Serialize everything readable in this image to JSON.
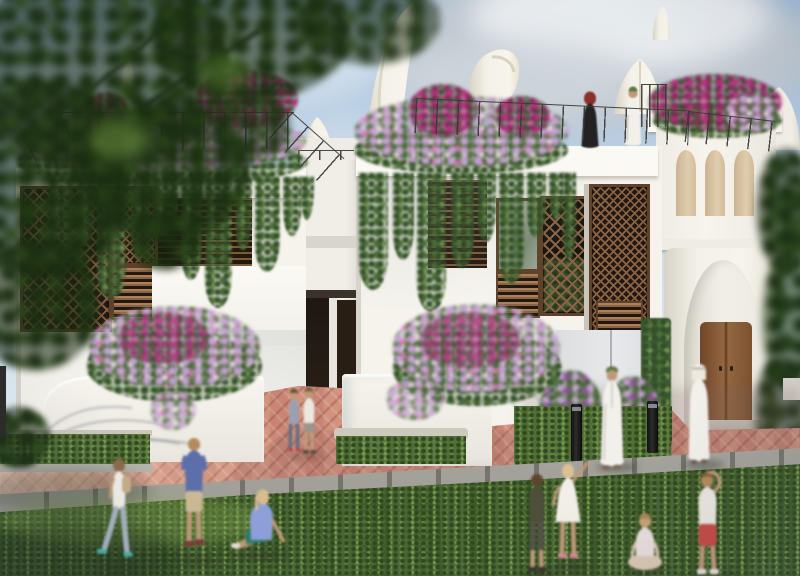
{
  "meta": {
    "type": "architectural-visualization",
    "description": "Sunlit rendering of white Arabian-style courtyard villas with wooden mashrabiya screens, cascading rooftop bougainvillea gardens, sail-shaped roof sculptures, a gateway tower with a wooden door, herringbone brick paths and children playing on a green lawn",
    "time_of_day": "late afternoon",
    "weather": "partly cloudy"
  },
  "palette": {
    "sky-top": "#9cbad9",
    "sky-mid": "#c3d7ea",
    "sky-low": "#e4eef6",
    "cloud-grey": "#c2c9d0",
    "cloud-light": "#e9edf0",
    "wall": "#f5f3ec",
    "wall-bright": "#fbf9f3",
    "wall-shade": "#e5e3db",
    "wall-grey": "#e0e1e3",
    "sail": "#f3f0e7",
    "sail-shade": "#d8d3c4",
    "wood": "#8a6342",
    "wood-dark": "#5e4128",
    "wood-deep": "#231811",
    "wood-light": "#aa8159",
    "glass": "#95a38d",
    "niche": "#dbc7a7",
    "door-a": "#936740",
    "door-b": "#6e4628",
    "rail": "#3a3a36",
    "vine": "#4d6d39",
    "vine-dark": "#33502a",
    "vine-light": "#70924f",
    "fl-magenta": "#bb3380",
    "fl-deep": "#8e2260",
    "fl-pink": "#d873ae",
    "fl-lav": "#c7a2d6",
    "fl-pale": "#ecd9e8",
    "fl-purple": "#8f4f9e",
    "grass": "#42602c",
    "grass-dark": "#30481e",
    "grass-light": "#7a9a50",
    "verge": "#567639",
    "brick": "#c98573",
    "brick-light": "#e2b19c",
    "brick-dark": "#a96753",
    "curb": "#b3b1a8",
    "curb-dark": "#8b897f",
    "hedge": "#3a5830",
    "leaf-tree": "#1b2e11",
    "leaf-tree2": "#2d481c",
    "leaf-hi": "#6c8f3f",
    "skin": "#c09a78",
    "thobe": "#f2f0ea",
    "abaya": "#232122",
    "hijab": "#8c2f2a",
    "cap": "#5c7a42"
  },
  "scene": {
    "sky": {
      "label": "Blue sky with soft grey-white clouds"
    },
    "foreground_tree": {
      "label": "Out-of-focus dark tree foliage framing the upper left corner"
    },
    "sails": {
      "label": "Curved white sail and horn shaped sculptures rising from the rooftops",
      "count": 8
    },
    "left_villa": {
      "label": "White villa with wooden mashrabiya lattice screens, louvered shutters, hanging vines and a rooftop flower garden"
    },
    "right_villa": {
      "label": "White villa with mashrabiya bay, rooftop terrace and flowering railing where two residents stand"
    },
    "gateway_tower": {
      "label": "White gateway tower with three beige arched niches, a grand arch and a wooden double door"
    },
    "passage": {
      "label": "Shaded entry passage between the villas with two dark doorways"
    },
    "left_planter": {
      "label": "Curved white planter bed with pink bougainvillea"
    },
    "right_planter": {
      "label": "Curved white planter bed with tall pink bougainvillea"
    },
    "pavement": {
      "label": "Herringbone red-brick paving with grey curb"
    },
    "lawn": {
      "label": "Green lawn in the foreground"
    },
    "hedge": {
      "label": "Clipped green hedge beside the gateway"
    },
    "trees_right": {
      "label": "Green trees at the right edge"
    },
    "bollards": {
      "label": "Two black bollard lights on the grass verge"
    },
    "people": [
      {
        "id": "rooftop-woman",
        "label": "Woman in black abaya and red headscarf standing on the rooftop terrace"
      },
      {
        "id": "rooftop-man",
        "label": "Man in white thobe and green cap standing on the rooftop terrace"
      },
      {
        "id": "kids-by-door",
        "label": "Two children standing together by the entrance passage"
      },
      {
        "id": "man-green-cap",
        "label": "Man in white thobe and green cap walking along the paved path"
      },
      {
        "id": "man-ghutra",
        "label": "Man in white thobe and white headdress walking near the gateway"
      },
      {
        "id": "girl-walking",
        "label": "Girl with a backpack walking across the lawn"
      },
      {
        "id": "boy-blue",
        "label": "Boy in a blue t-shirt standing on the lawn"
      },
      {
        "id": "girl-sitting",
        "label": "Girl in a lavender top sitting on the grass"
      },
      {
        "id": "boy-olive",
        "label": "Boy in an olive shirt standing on the lawn"
      },
      {
        "id": "girl-pointing",
        "label": "Girl in a white dress pointing up at the sky"
      },
      {
        "id": "child-sitting",
        "label": "Child sitting cross-legged on the grass"
      },
      {
        "id": "boy-red-shorts",
        "label": "Boy in red shorts reaching up"
      }
    ]
  }
}
